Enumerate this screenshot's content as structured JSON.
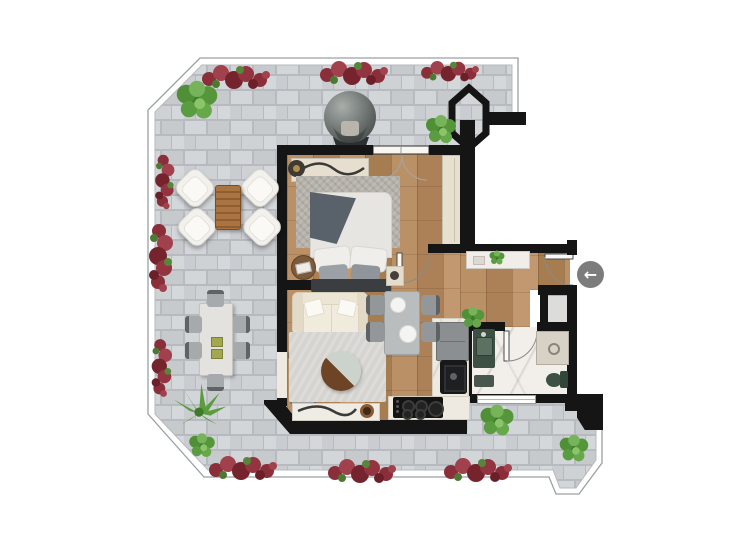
{
  "plan": {
    "type": "apartment-floor-plan-2d",
    "entry": {
      "arrow_glyph": "←",
      "direction": "entry-from-right"
    },
    "colors": {
      "background": "#ffffff",
      "wall": "#151515",
      "terrace_paver": "#cdd0d3",
      "wood_floor": "#b2885e",
      "bathroom_marble": "#f2efeb",
      "bedroom_rug": "#b6b2ab",
      "living_rug": "#d6d4d1",
      "wardrobe": "#e7e0d1",
      "fixture_green": "#3c5143",
      "flower_red": "#8e2f3a",
      "plant_green": "#4c8a33",
      "arrow_circle": "#7c7c7c",
      "egg_chair_gray": "#707674"
    },
    "rooms": [
      {
        "name": "terrace",
        "floor": "stone-pavers",
        "furniture": [
          "hanging-egg-chair",
          "lounge-chair x4",
          "wood-coffee-table",
          "outdoor-dining-table",
          "outdoor-chair x6",
          "flower-beds",
          "plants"
        ]
      },
      {
        "name": "bedroom",
        "floor": "wood",
        "furniture": [
          "double-bed",
          "headboard",
          "pillows",
          "throw-blanket",
          "rug",
          "dresser-console",
          "sculpture",
          "stool",
          "nightstand x2",
          "wardrobe",
          "glass-door-to-terrace"
        ]
      },
      {
        "name": "living-room",
        "floor": "wood",
        "furniture": [
          "sofa",
          "round-coffee-table",
          "rug",
          "console-table",
          "decor-bowl",
          "double-door-to-terrace"
        ]
      },
      {
        "name": "kitchen-dining",
        "floor": "wood",
        "furniture": [
          "dining-table",
          "chair x4",
          "fridge",
          "sink",
          "cooktop",
          "counters",
          "plant"
        ]
      },
      {
        "name": "bathroom",
        "floor": "marble",
        "furniture": [
          "vanity-with-sink",
          "shower",
          "toilet",
          "bath-mat",
          "window"
        ]
      },
      {
        "name": "entry-hall",
        "floor": "wood",
        "furniture": [
          "console-table",
          "plant",
          "entry-door"
        ]
      },
      {
        "name": "shaft",
        "floor": "none",
        "furniture": []
      }
    ],
    "symbols": [
      {
        "name": "hexagonal-column",
        "location": "top-right-terrace"
      },
      {
        "name": "entry-arrow",
        "glyph": "←"
      },
      {
        "name": "door-swing-arc",
        "count": 5
      }
    ]
  }
}
